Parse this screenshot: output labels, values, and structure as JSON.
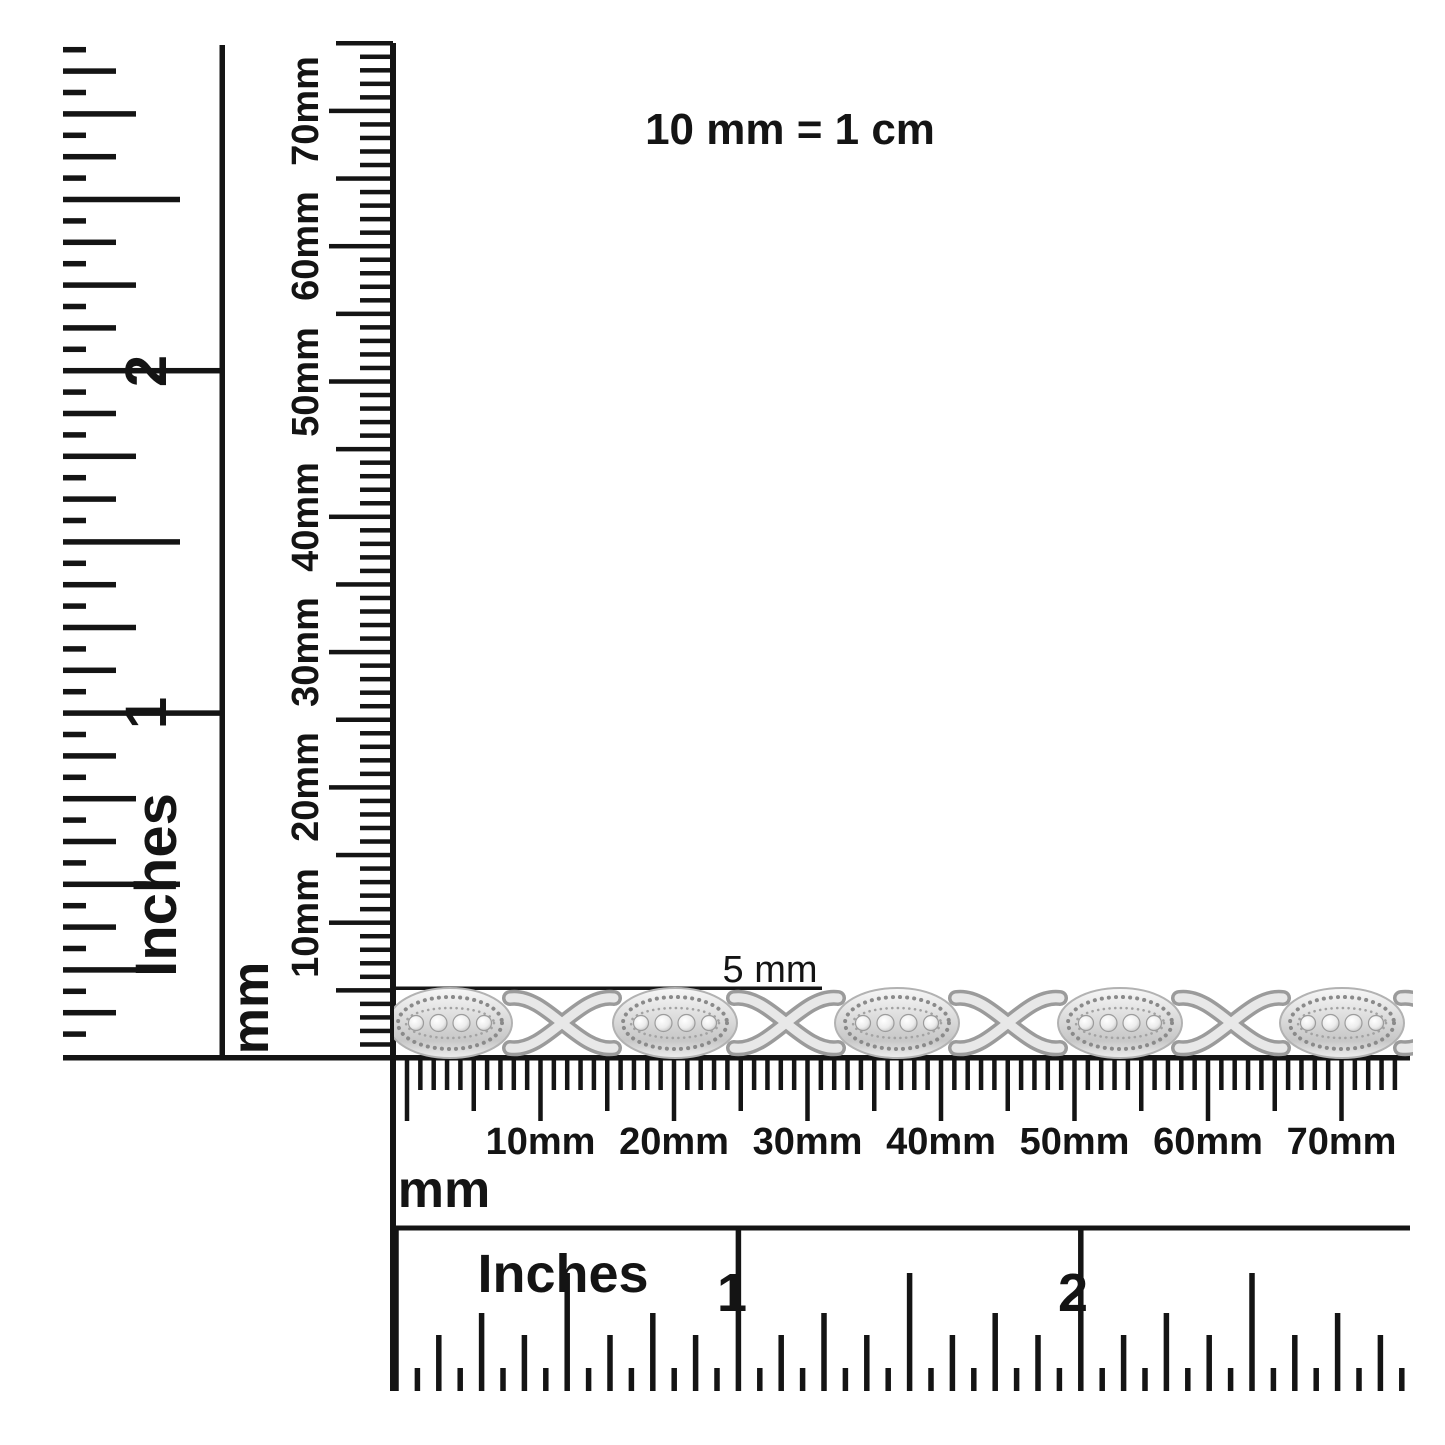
{
  "colors": {
    "ink": "#141414",
    "paper": "#ffffff",
    "silver_light": "#f6f6f6",
    "silver_mid": "#d9d9d9",
    "silver_dark": "#9b9b9b"
  },
  "scale_note": "10 mm = 1 cm",
  "bracelet": {
    "size_label": "5 mm",
    "description": "silver XO-link bracelet, pavé diamond marquise links with milgrain edges alternating with polished X links",
    "oval_link_count": 5,
    "x_link_count": 5
  },
  "vertical_inch_ruler": {
    "unit_label": "Inches",
    "numerals": [
      "1",
      "2"
    ]
  },
  "vertical_mm_ruler": {
    "unit_label": "mm",
    "tick_labels": [
      "10mm",
      "20mm",
      "30mm",
      "40mm",
      "50mm",
      "60mm",
      "70mm"
    ]
  },
  "horizontal_mm_ruler": {
    "unit_label": "mm",
    "tick_labels": [
      "10mm",
      "20mm",
      "30mm",
      "40mm",
      "50mm",
      "60mm",
      "70mm"
    ]
  },
  "horizontal_inch_ruler": {
    "unit_label": "Inches",
    "numerals": [
      "1",
      "2"
    ]
  }
}
